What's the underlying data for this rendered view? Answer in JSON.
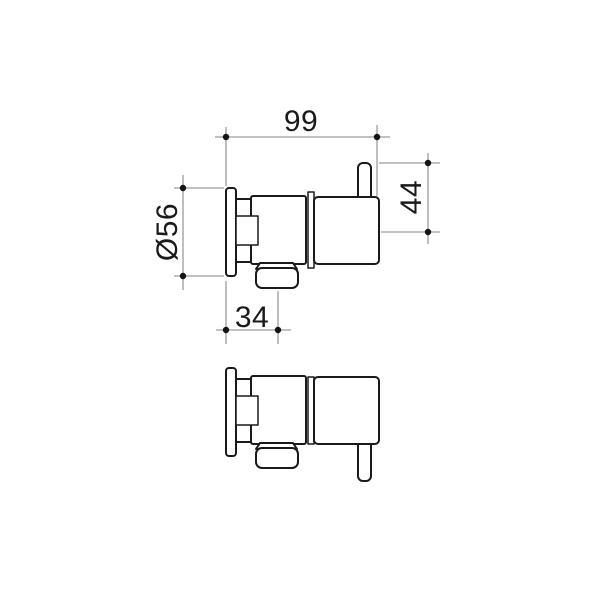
{
  "drawing": {
    "dimensions": {
      "overall_width": "99",
      "handle_height": "44",
      "flange_diameter": "Ø56",
      "outlet_offset": "34"
    },
    "colors": {
      "background": "#ffffff",
      "outline": "#1a1a1a",
      "dimension_lines": "#9c9c9c",
      "dimension_dots": "#141414",
      "dimension_text": "#1a1a1a"
    }
  }
}
